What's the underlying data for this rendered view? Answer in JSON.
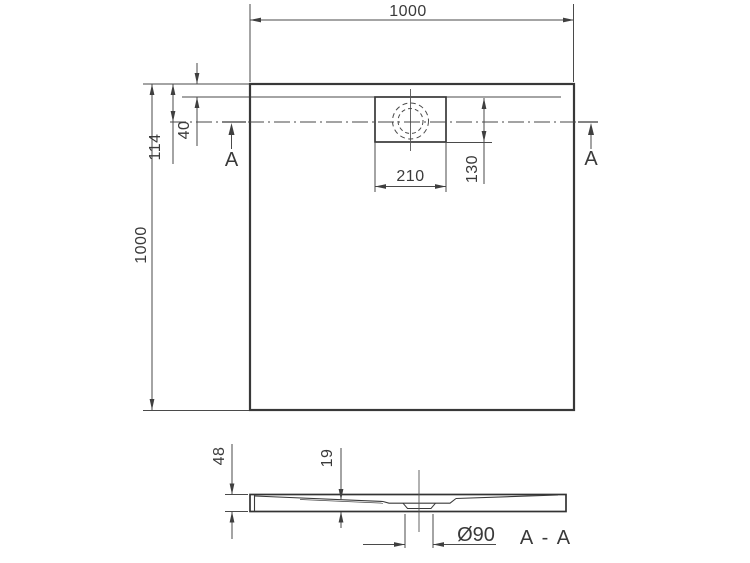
{
  "top_view": {
    "width_dim": "1000",
    "height_dim": "1000",
    "edge_to_drain_dim": "114",
    "rim_dim": "40",
    "drain_box_width_dim": "210",
    "drain_box_height_dim": "130",
    "section_marker_left": "A",
    "section_marker_right": "A"
  },
  "section_view": {
    "height_dim": "48",
    "drain_depth_dim": "19",
    "drain_diameter_dim": "Ø90",
    "label": "A - A"
  },
  "colors": {
    "outline": "#383838",
    "dimension_lines": "#4a4a4a",
    "text": "#3a3a3a",
    "background": "#ffffff"
  }
}
